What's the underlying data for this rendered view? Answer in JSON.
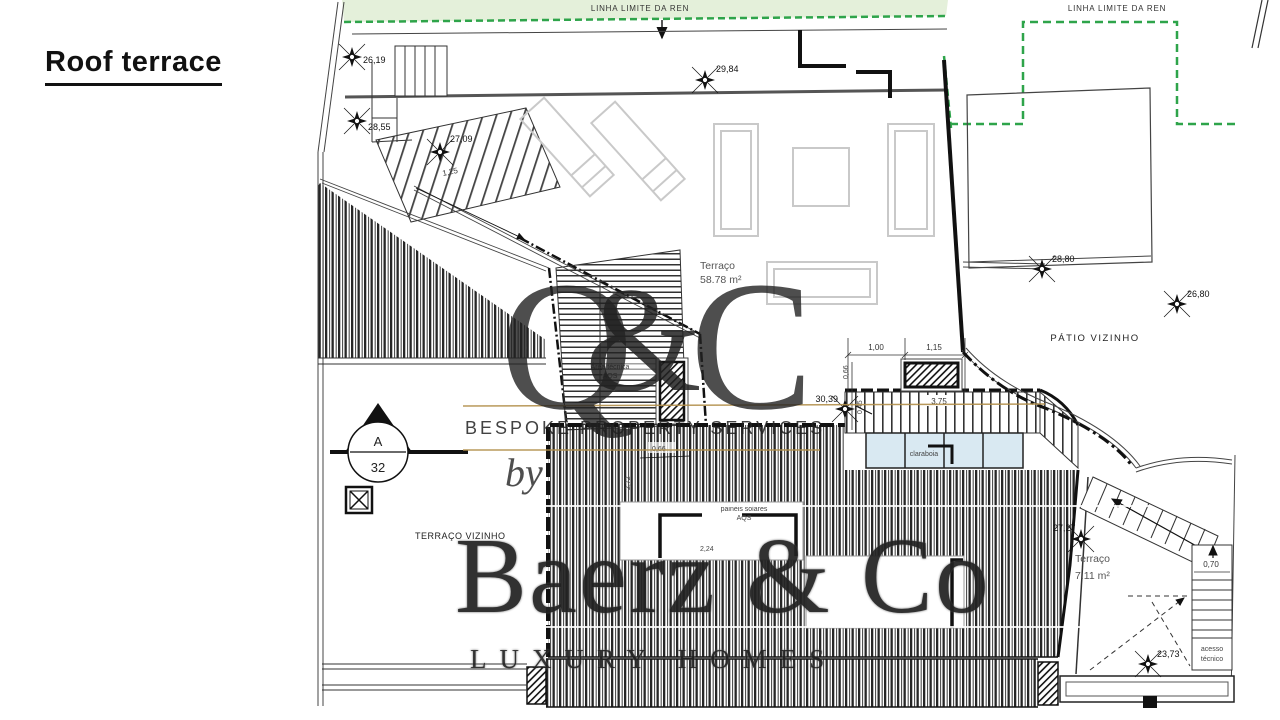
{
  "title": "Roof terrace",
  "plan": {
    "ren_band": {
      "label_left": "LINHA LIMITE DA REN",
      "label_right": "LINHA LIMITE DA REN"
    },
    "labels": {
      "patio_vizinho": "PÁTIO VIZINHO",
      "terraco_vizinho": "TERRAÇO VIZINHO",
      "terraco_main_name": "Terraço",
      "terraco_main_area": "58.78 m²",
      "terraco_small_name": "Terraço",
      "terraco_small_area": "7.11 m²",
      "area_tecnica_1": "Área técnica",
      "area_tecnica_2": "AQS",
      "paineis_1": "painéis solares",
      "paineis_2": "AQS",
      "claraboia": "claraboia",
      "acesso_1": "acesso",
      "acesso_2": "técnico"
    },
    "elevations": {
      "e1": "26,19",
      "e2": "28,55",
      "e3": "27,09",
      "e4": "29,84",
      "e5": "28,80",
      "e6": "26,80",
      "e7": "30,39",
      "e8": "27,27",
      "e9": "23,73"
    },
    "dimensions": {
      "d125": "1,25",
      "d100": "1,00",
      "d115": "1,15",
      "d066a": "0,66",
      "d045": "0,45",
      "d375": "3,75",
      "d066b": "0,66",
      "d272": "2,72",
      "d224": "2,24",
      "d070": "0,70"
    },
    "section_marker": {
      "letter": "A",
      "number": "32"
    }
  },
  "watermark": {
    "q": "Q",
    "amp": "&",
    "c": "C",
    "services": "BESPOKE PROPERTY SERVICES",
    "by": "by",
    "brand": "Baerz & Co",
    "tagline": "LUXURY HOMES"
  },
  "colors": {
    "ren_green": "#2ea44a",
    "ren_fill": "#e4f0da",
    "claraboia_blue": "#d9e9f2",
    "furniture_gray": "#c9c9c9",
    "wm_teal": "#4c7a6e",
    "wm_gold": "#b28f4a"
  }
}
